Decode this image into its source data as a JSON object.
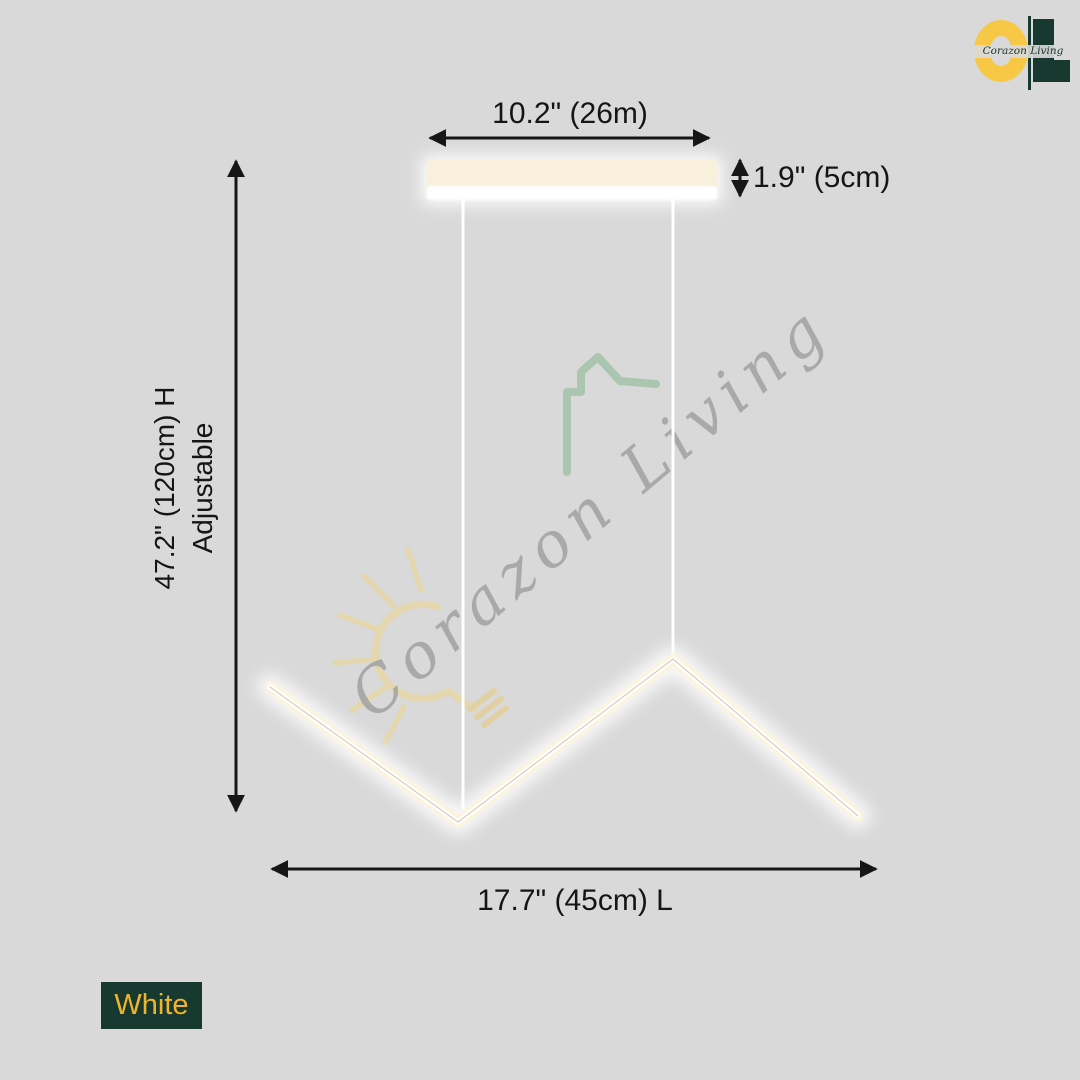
{
  "page": {
    "background": "#d9d9d9"
  },
  "brand": {
    "logo_script": "Corazon Living",
    "c_color": "#f6c845",
    "dark_color": "#17392f"
  },
  "watermark": {
    "script": "Corazon Living",
    "script_color": "#a3a3a3",
    "house_icon_color": "#a5c3a9",
    "bulb_icon_color": "#e7d7a6"
  },
  "dimensions": {
    "width_top": "10.2\" (26m)",
    "canopy_height": "1.9\" (5cm)",
    "height_line1": "47.2\" (120cm) H",
    "height_line2": "Adjustable",
    "length_bottom": "17.7\" (45cm) L"
  },
  "variant": {
    "label": "White",
    "chip_bg": "#17392f",
    "chip_text_color": "#eeb42c"
  },
  "fixture": {
    "glow_core": "#ffffff",
    "glow_warm": "#fdf3d9",
    "canopy_fill": "#f8f0db"
  },
  "icons": {
    "watermark_bulb": "sunburst-lightbulb-icon",
    "watermark_house": "house-outline-icon",
    "logo_c": "letter-c-ring",
    "logo_l": "letter-l-block"
  }
}
